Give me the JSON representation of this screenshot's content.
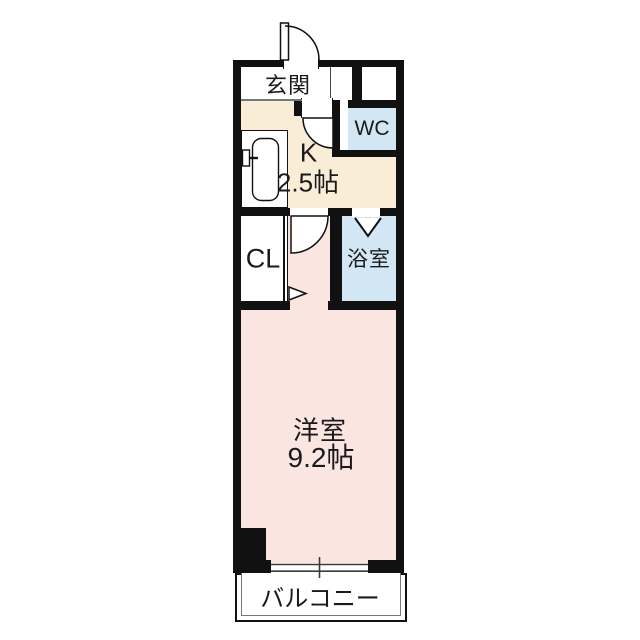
{
  "floorplan": {
    "rooms": {
      "genkan": {
        "label": "玄関"
      },
      "wc": {
        "label": "WC"
      },
      "kitchen": {
        "label": "K",
        "size_label": "2.5帖"
      },
      "closet": {
        "label": "CL"
      },
      "bathroom": {
        "label": "浴室"
      },
      "main_room": {
        "label": "洋室",
        "size_label": "9.2帖"
      },
      "balcony": {
        "label": "バルコニー"
      }
    },
    "icons": {
      "entrance_door": "quarter-arc-swing-out",
      "kitchen_door": "quarter-arc-swing-in",
      "hall_door": "quarter-arc-swing-in",
      "bathroom_door": "folding-door-v",
      "closet_door": "sliding-door-arrow",
      "window": "sliding-window-double-line",
      "kitchen_sink": "counter-with-basin-and-faucet"
    },
    "colors": {
      "wall": "#111111",
      "kitchen_fill": "#f9edd8",
      "water_fill": "#d3e6f4",
      "room_fill": "#fbe5e1",
      "background": "#ffffff"
    }
  }
}
